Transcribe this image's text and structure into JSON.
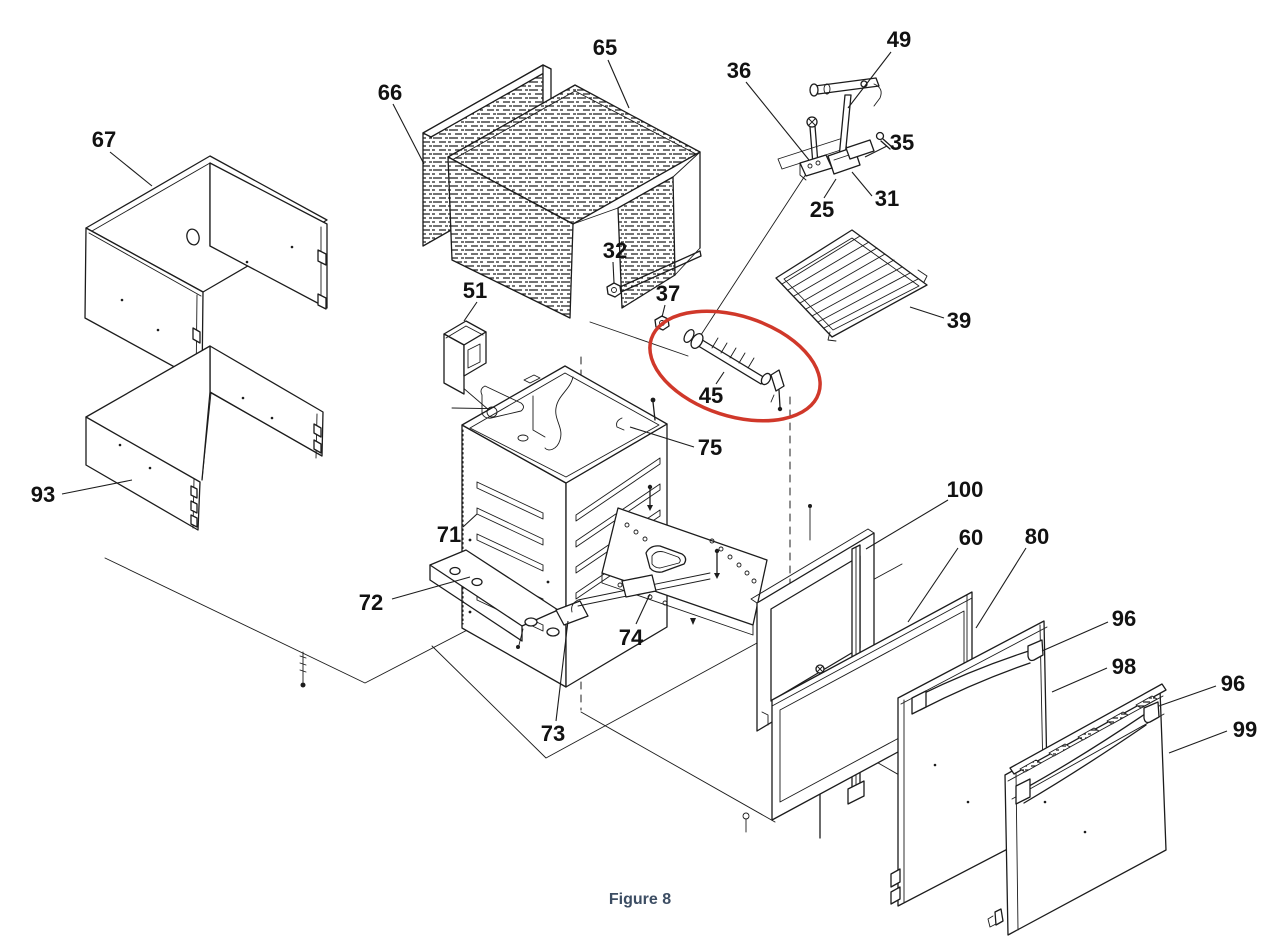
{
  "figure_caption": "Figure 8",
  "colors": {
    "line": "#1c1c1c",
    "label": "#121212",
    "caption": "#3c4d63",
    "highlight": "#d0382a",
    "background": "#ffffff"
  },
  "highlight": {
    "shape": "ellipse",
    "part": "45",
    "cx": 735,
    "cy": 366,
    "rx": 88,
    "ry": 50,
    "rotation": 18
  },
  "part_labels": [
    {
      "text": "67",
      "x": 104,
      "y": 139,
      "leader": [
        [
          110,
          152
        ],
        [
          152,
          186
        ]
      ]
    },
    {
      "text": "66",
      "x": 390,
      "y": 92,
      "leader": [
        [
          393,
          104
        ],
        [
          424,
          164
        ]
      ]
    },
    {
      "text": "65",
      "x": 605,
      "y": 47,
      "leader": [
        [
          608,
          60
        ],
        [
          629,
          108
        ]
      ]
    },
    {
      "text": "49",
      "x": 899,
      "y": 39,
      "leader": [
        [
          891,
          52
        ],
        [
          848,
          108
        ]
      ]
    },
    {
      "text": "36",
      "x": 739,
      "y": 70,
      "leader": [
        [
          746,
          82
        ],
        [
          809,
          160
        ]
      ]
    },
    {
      "text": "35",
      "x": 902,
      "y": 142,
      "leader": [
        [
          887,
          146
        ],
        [
          865,
          157
        ]
      ]
    },
    {
      "text": "31",
      "x": 887,
      "y": 198,
      "leader": [
        [
          872,
          196
        ],
        [
          852,
          172
        ]
      ]
    },
    {
      "text": "25",
      "x": 822,
      "y": 209,
      "leader": [
        [
          824,
          198
        ],
        [
          836,
          179
        ]
      ]
    },
    {
      "text": "32",
      "x": 615,
      "y": 250,
      "leader": [
        [
          613,
          262
        ],
        [
          614,
          283
        ]
      ]
    },
    {
      "text": "51",
      "x": 475,
      "y": 290,
      "leader": [
        [
          477,
          302
        ],
        [
          464,
          321
        ]
      ]
    },
    {
      "text": "37",
      "x": 668,
      "y": 293,
      "leader": [
        [
          665,
          305
        ],
        [
          662,
          317
        ]
      ]
    },
    {
      "text": "39",
      "x": 959,
      "y": 320,
      "leader": [
        [
          944,
          318
        ],
        [
          910,
          307
        ]
      ]
    },
    {
      "text": "45",
      "x": 711,
      "y": 395,
      "leader": [
        [
          716,
          384
        ],
        [
          724,
          372
        ]
      ]
    },
    {
      "text": "75",
      "x": 710,
      "y": 447,
      "leader": [
        [
          694,
          447
        ],
        [
          630,
          427
        ]
      ]
    },
    {
      "text": "71",
      "x": 449,
      "y": 534,
      "leader": [
        [
          463,
          527
        ],
        [
          477,
          514
        ]
      ]
    },
    {
      "text": "72",
      "x": 371,
      "y": 602,
      "leader": [
        [
          392,
          599
        ],
        [
          470,
          577
        ]
      ]
    },
    {
      "text": "73",
      "x": 553,
      "y": 733,
      "leader": [
        [
          556,
          721
        ],
        [
          568,
          621
        ]
      ]
    },
    {
      "text": "74",
      "x": 631,
      "y": 637,
      "leader": [
        [
          636,
          624
        ],
        [
          650,
          594
        ]
      ]
    },
    {
      "text": "93",
      "x": 43,
      "y": 494,
      "leader": [
        [
          62,
          494
        ],
        [
          132,
          480
        ]
      ]
    },
    {
      "text": "100",
      "x": 965,
      "y": 489,
      "leader": [
        [
          948,
          500
        ],
        [
          866,
          549
        ]
      ]
    },
    {
      "text": "60",
      "x": 971,
      "y": 537,
      "leader": [
        [
          958,
          548
        ],
        [
          908,
          622
        ]
      ]
    },
    {
      "text": "80",
      "x": 1037,
      "y": 536,
      "leader": [
        [
          1026,
          548
        ],
        [
          976,
          628
        ]
      ]
    },
    {
      "text": "96",
      "x": 1124,
      "y": 618,
      "leader": [
        [
          1108,
          622
        ],
        [
          1042,
          651
        ]
      ]
    },
    {
      "text": "98",
      "x": 1124,
      "y": 666,
      "leader": [
        [
          1107,
          668
        ],
        [
          1052,
          692
        ]
      ]
    },
    {
      "text": "96",
      "x": 1233,
      "y": 683,
      "leader": [
        [
          1216,
          686
        ],
        [
          1159,
          706
        ]
      ]
    },
    {
      "text": "99",
      "x": 1245,
      "y": 729,
      "leader": [
        [
          1227,
          731
        ],
        [
          1169,
          753
        ]
      ]
    }
  ]
}
